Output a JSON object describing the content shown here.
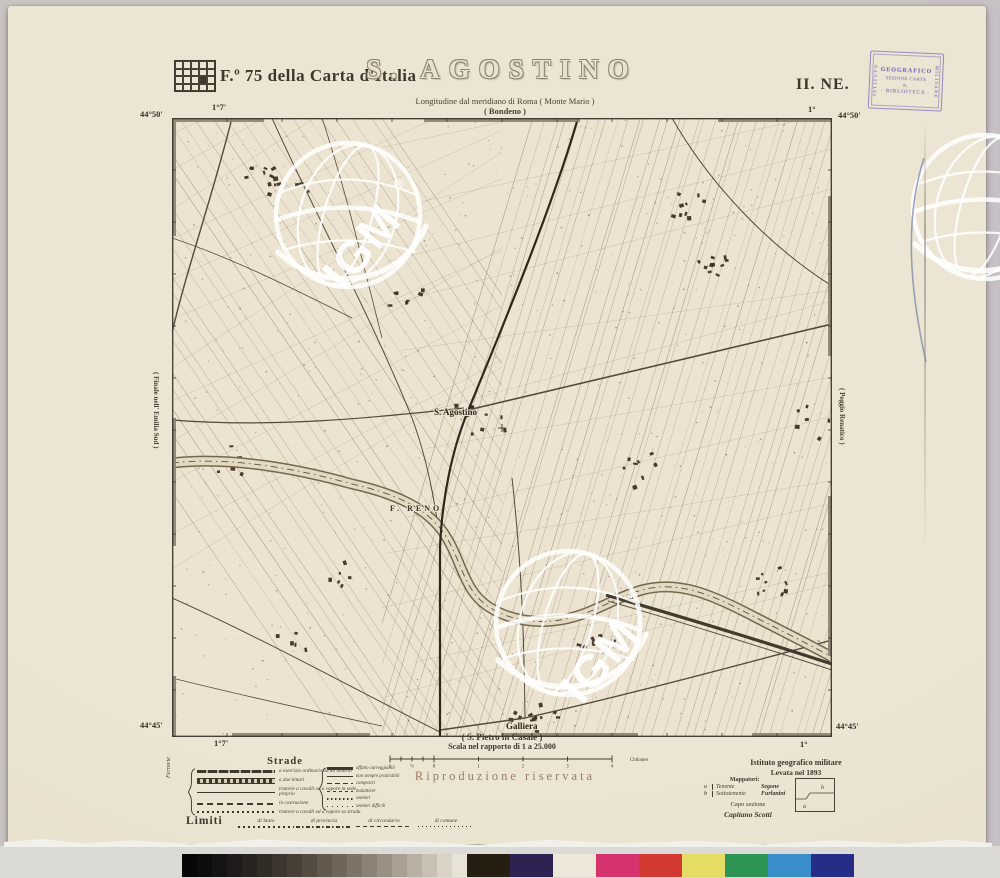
{
  "header": {
    "sheet_label": "F.º 75 della Carta d'Italia",
    "title": "S. AGOSTINO",
    "quadrant": "II. NE.",
    "subtitle": "Longitudine dal meridiano di Roma ( Monte Mario )",
    "adjacent_top": "( Bondeno )"
  },
  "stamp": {
    "side_left": "ISTITUTO",
    "side_right": "MILITARE",
    "line1": "GEOGRAFICO",
    "line2": "SEZIONE CARTA",
    "line3": "N.",
    "line4": "· BIBLIOTECA ·"
  },
  "frame": {
    "lat_top": "44°50'",
    "lat_bottom": "44°45'",
    "lon_left": "1°7'",
    "lon_right": "1°",
    "adjacent_left": "( Finale nell' Emilia Sud )",
    "adjacent_right": "( Poggio Renatico )",
    "adjacent_bottom": "( S. Pietro in Casale )"
  },
  "map_labels": {
    "town": "S. Agostino",
    "river": "F. RENO",
    "village": "Galliera"
  },
  "scale": {
    "caption": "Scala nel rapporto di 1 a 25.000",
    "unit": "Chilometri",
    "zero_labels": [
      "1",
      "½",
      "0"
    ],
    "km_labels": [
      "1",
      "2",
      "3",
      "4"
    ]
  },
  "legend": {
    "strade_heading": "Strade",
    "ferrovie_label": "Ferrovie",
    "rotabili_label": "Rotabili",
    "rows_left": [
      "a esercizio ordinario ad un binario",
      "a due binari",
      "tramvie a cavalli od a vapore in sede propria",
      "in costruzione",
      "tramvie a cavalli od a vapore su strada"
    ],
    "rows_right": [
      "affatto carreggiabili",
      "non sempre praticabili",
      "campestri",
      "mulattiere",
      "sentieri",
      "sentieri difficili"
    ],
    "limiti_heading": "Limiti",
    "limiti_items": [
      "di Stato",
      "di provincia",
      "di circondario",
      "di comune"
    ]
  },
  "notice": "Riproduzione riservata",
  "credits": {
    "institute": "Istituto geografico militare",
    "survey": "Levata nel 1893",
    "mappers_heading": "Mappatori:",
    "mapper_a_key": "a",
    "mapper_a_rank": "Tenente",
    "mapper_a_name": "Segone",
    "mapper_b_key": "b",
    "mapper_b_rank": "Sottotenente",
    "mapper_b_name": "Furlanini",
    "chief_heading": "Capo sezione",
    "chief_rank": "Capitano",
    "chief_name": "Scotti",
    "index_a": "a",
    "index_b": "b"
  },
  "watermark": {
    "text": "IGM",
    "registered": "®"
  },
  "colors": {
    "paper": "#ebe3d1",
    "ink": "#3f362c",
    "stamp_purple": "#8268b8",
    "notice_brown": "#8a6a50"
  },
  "calibration": {
    "grays": [
      "#070707",
      "#0e0d0c",
      "#161412",
      "#1e1b18",
      "#27231f",
      "#312c26",
      "#3b352e",
      "#474037",
      "#544c41",
      "#62594c",
      "#6f6559",
      "#7d7367",
      "#8b8175",
      "#9a9083",
      "#a9a092",
      "#b8b0a2",
      "#c8c1b3",
      "#d9d3c6",
      "#e8e3d7"
    ],
    "patches": [
      "#251e11",
      "#2d2251",
      "#ece7d8",
      "#d5336e",
      "#d23a31",
      "#e5dc66",
      "#2f9556",
      "#3a8fca",
      "#272c86"
    ]
  }
}
